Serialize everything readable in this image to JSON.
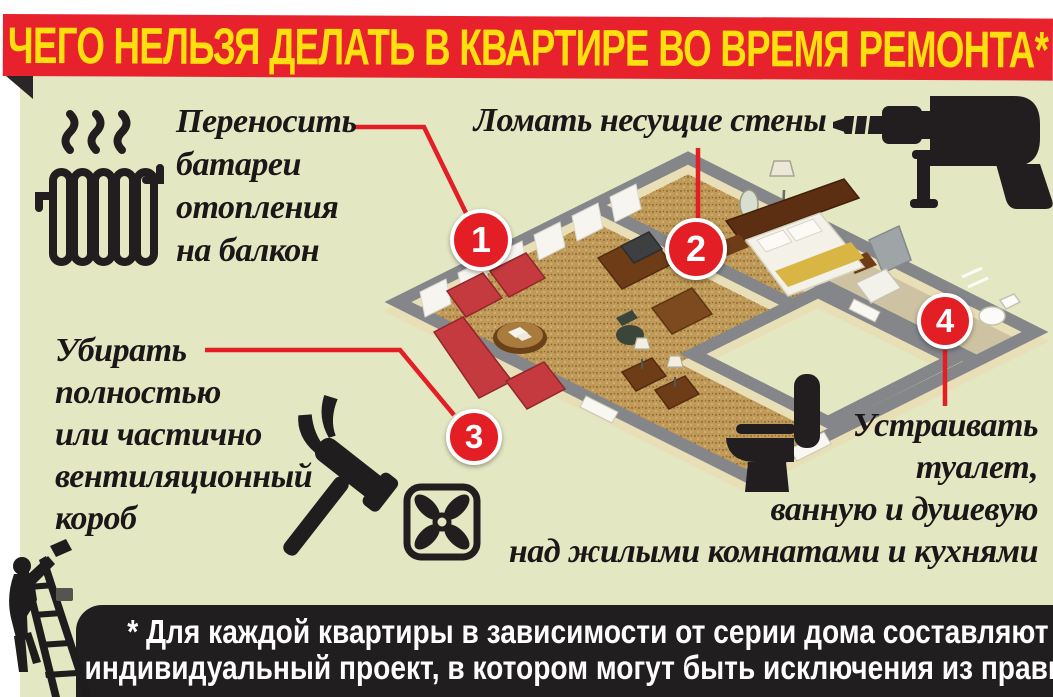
{
  "poster": {
    "title": "ЧЕГО НЕЛЬЗЯ ДЕЛАТЬ В КВАРТИРЕ ВО ВРЕМЯ РЕМОНТА*",
    "footnote_lines": [
      "* Для каждой квартиры в зависимости от серии дома составляют",
      "индивидуальный проект, в котором могут быть исключения из правил."
    ]
  },
  "rules": [
    {
      "number": "1",
      "label": "Переносить батареи отопления на балкон",
      "lines": [
        "Переносить",
        "батареи",
        "отопления",
        "на балкон"
      ],
      "icon": "radiator-icon"
    },
    {
      "number": "2",
      "label": "Ломать несущие стены",
      "lines": [
        "Ломать несущие стены"
      ],
      "icon": "drill-icon"
    },
    {
      "number": "3",
      "label": "Убирать полностью или частично вентиляционный короб",
      "lines": [
        "Убирать",
        "полностью",
        "или частично",
        "вентиляционный",
        "короб"
      ],
      "icon": "ventilation-fan-icon"
    },
    {
      "number": "4",
      "label": "Устраивать туалет, ванную и душевую над жилыми комнатами и кухнями",
      "lines": [
        "Устраивать",
        "туалет,",
        "ванную и душевую",
        "над жилыми комнатами и кухнями"
      ],
      "icon": "toilet-icon"
    }
  ],
  "illustration": {
    "description": "Изометрический разрез квартиры: гостиная с красной мебелью, спальня, ванная",
    "decor_icons": [
      "radiator-icon",
      "drill-icon",
      "hammer-icon",
      "ventilation-fan-icon",
      "toilet-icon",
      "painter-on-ladder-icon"
    ]
  },
  "colors": {
    "banner_red": "#e8222d",
    "banner_yellow": "#ffdf0e",
    "panel_green": "#e3e7c2",
    "callout_red": "#e31e24",
    "ink_black": "#211e1f",
    "wall_cream": "#e9dfb6",
    "wall_top_gray": "#84868a",
    "carpet_gold": "#bf9a58",
    "furniture_red": "#c43a3e"
  }
}
